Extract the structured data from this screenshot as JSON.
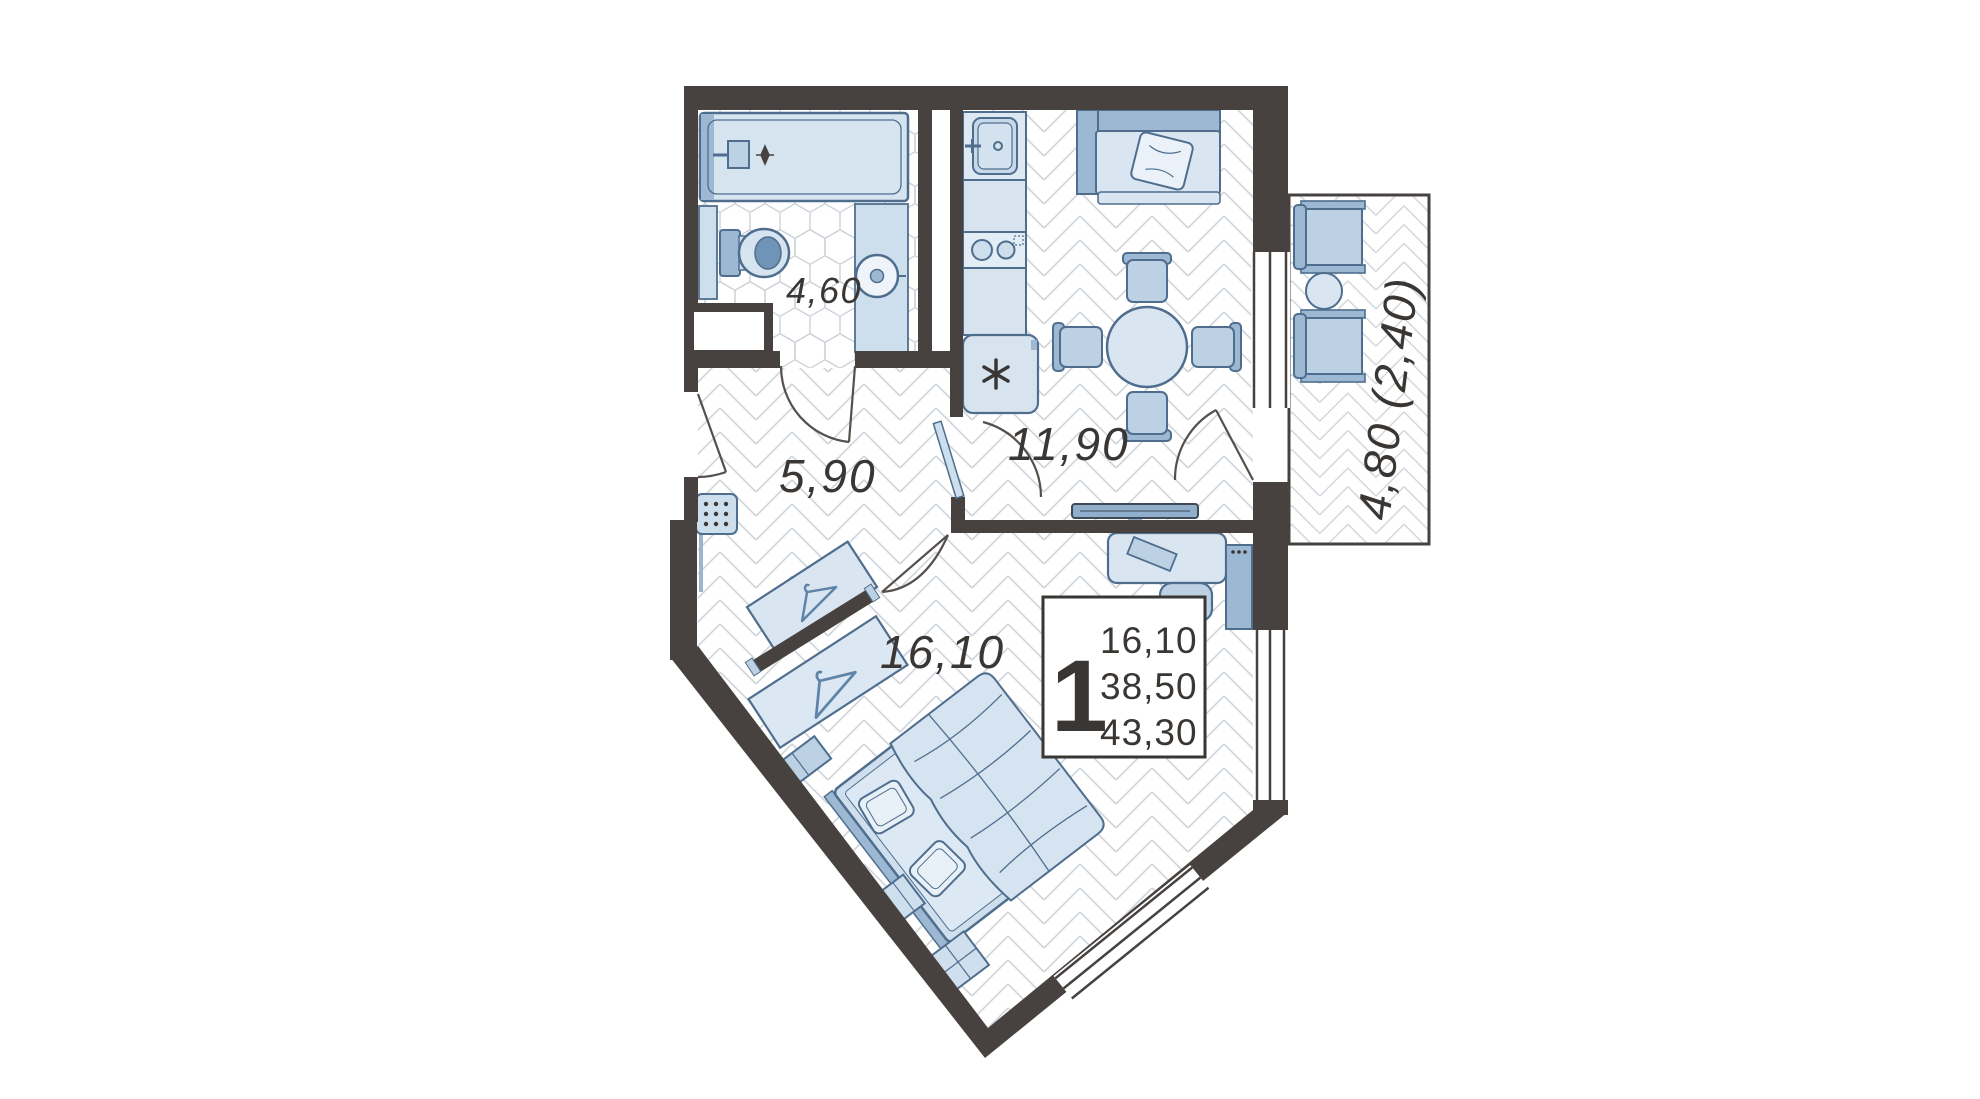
{
  "plan": {
    "title": "one-room apartment floor plan",
    "rooms": {
      "bathroom": {
        "name": "bathroom",
        "area": "4,60"
      },
      "kitchen_living": {
        "name": "kitchen-living room",
        "area": "11,90"
      },
      "hallway": {
        "name": "hallway",
        "area": "5,90"
      },
      "bedroom": {
        "name": "bedroom",
        "area": "16,10"
      },
      "balcony": {
        "name": "balcony",
        "area": "4,80 (2,40)"
      }
    },
    "unit_badge": {
      "rooms": "1",
      "living_area": "16,10",
      "apartment_area": "38,50",
      "total_area": "43,30"
    },
    "palette": {
      "wall": "#474240",
      "furniture_outline": "#4f6e8e",
      "furniture_light": "#d9e6f1",
      "furniture_mid": "#bcd1e4",
      "furniture_dark": "#9db8d2",
      "accent_dark": "#6f94b8",
      "floor_line": "#cfd5da",
      "text": "#3a3633",
      "background": "#ffffff"
    }
  }
}
